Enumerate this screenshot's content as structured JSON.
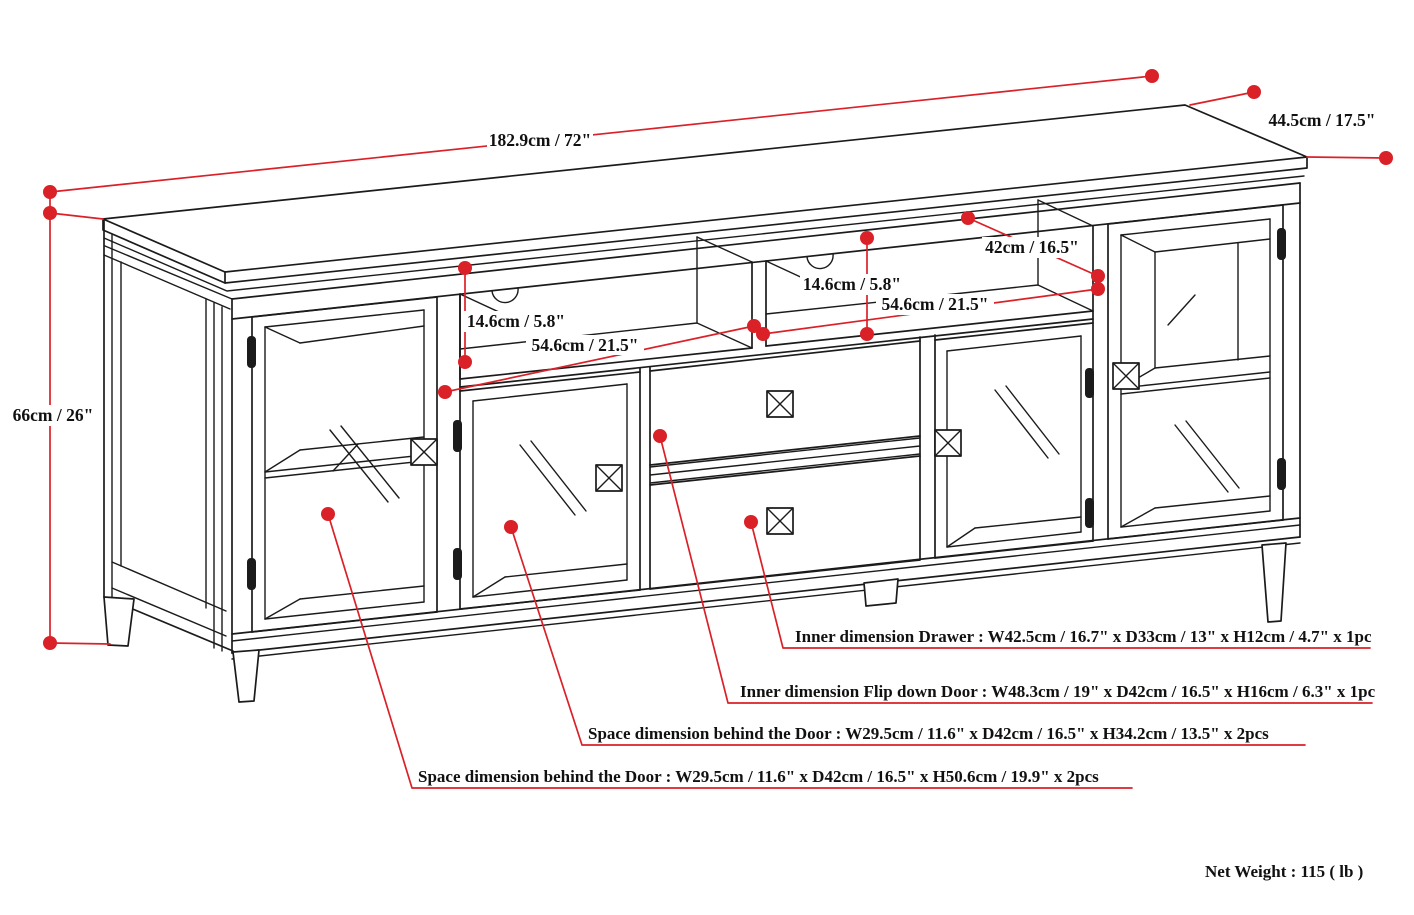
{
  "labels": {
    "width": "182.9cm / 72\"",
    "depth": "44.5cm / 17.5\"",
    "height": "66cm / 26\"",
    "shelf_depth": "42cm / 16.5\"",
    "shelf_height_left": "14.6cm / 5.8\"",
    "shelf_height_right": "14.6cm / 5.8\"",
    "bay_width_left": "54.6cm / 21.5\"",
    "bay_width_right": "54.6cm / 21.5\""
  },
  "callouts": {
    "drawer": "Inner dimension Drawer : W42.5cm / 16.7\" x D33cm / 13\" x H12cm / 4.7\" x 1pc",
    "flip_down_door": "Inner dimension Flip down Door : W48.3cm / 19\" x D42cm / 16.5\" x H16cm / 6.3\" x 1pc",
    "door_space_short": "Space dimension behind the Door  : W29.5cm / 11.6\" x D42cm / 16.5\" x H34.2cm / 13.5\" x 2pcs",
    "door_space_tall": "Space dimension behind the Door  : W29.5cm / 11.6\" x D42cm / 16.5\" x H50.6cm / 19.9\" x 2pcs"
  },
  "footer": {
    "net_weight": "Net Weight : 115 ( lb )"
  },
  "colors": {
    "accent": "#da2128",
    "line": "#1b1b1b"
  }
}
